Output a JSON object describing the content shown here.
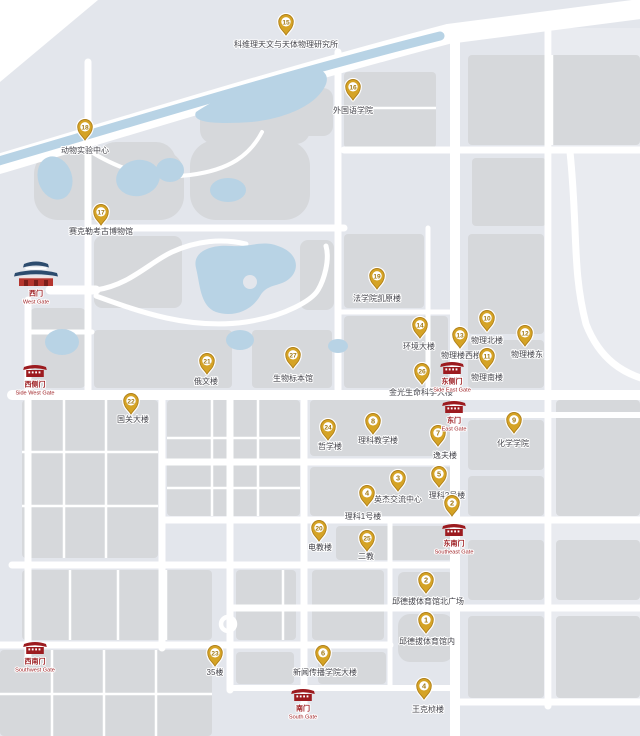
{
  "map": {
    "colors": {
      "background": "#e3e6ec",
      "background_east": "#e9ebf0",
      "building": "#d6d8db",
      "road": "#ffffff",
      "water": "#b8d3e5",
      "marker": "#d5a325",
      "marker_edge": "#b0801a",
      "marker_number": "#a27a15",
      "label": "#45454c",
      "gate_red": "#9c1b1f",
      "gate_base": "#b5352e",
      "gate_blue": "#2d4c6e"
    },
    "markers": [
      {
        "num": "15",
        "x": 286,
        "y": 35,
        "label": "科维理天文与天体物理研究所",
        "lx": 286,
        "ly": 47
      },
      {
        "num": "16",
        "x": 353,
        "y": 100,
        "label": "外国语学院",
        "lx": 353,
        "ly": 113
      },
      {
        "num": "18",
        "x": 85,
        "y": 140,
        "label": "动物实验中心",
        "lx": 85,
        "ly": 153
      },
      {
        "num": "17",
        "x": 101,
        "y": 225,
        "label": "赛克勒考古博物馆",
        "lx": 101,
        "ly": 234
      },
      {
        "num": "19",
        "x": 377,
        "y": 289,
        "label": "法学院凯原楼",
        "lx": 377,
        "ly": 301
      },
      {
        "num": "10",
        "x": 487,
        "y": 331,
        "label": "物理北楼",
        "lx": 487,
        "ly": 343
      },
      {
        "num": "14",
        "x": 420,
        "y": 338,
        "label": "环境大楼",
        "lx": 419,
        "ly": 349
      },
      {
        "num": "12",
        "x": 525,
        "y": 346,
        "label": "物理楼东",
        "lx": 527,
        "ly": 357
      },
      {
        "num": "13",
        "x": 460,
        "y": 348,
        "label": "物理楼西楼",
        "lx": 461,
        "ly": 358
      },
      {
        "num": "11",
        "x": 487,
        "y": 369,
        "label": "物理南楼",
        "lx": 487,
        "ly": 380
      },
      {
        "num": "27",
        "x": 293,
        "y": 368,
        "label": "生物标本馆",
        "lx": 293,
        "ly": 381
      },
      {
        "num": "21",
        "x": 207,
        "y": 374,
        "label": "俄文楼",
        "lx": 206,
        "ly": 384
      },
      {
        "num": "26",
        "x": 422,
        "y": 384,
        "label": "金光生命科学大楼",
        "lx": 421,
        "ly": 395
      },
      {
        "num": "22",
        "x": 131,
        "y": 414,
        "label": "国关大楼",
        "lx": 133,
        "ly": 422
      },
      {
        "num": "8",
        "x": 373,
        "y": 434,
        "label": "理科教学楼",
        "lx": 378,
        "ly": 443
      },
      {
        "num": "9",
        "x": 514,
        "y": 433,
        "label": "化学学院",
        "lx": 513,
        "ly": 446
      },
      {
        "num": "24",
        "x": 328,
        "y": 440,
        "label": "哲学楼",
        "lx": 330,
        "ly": 449
      },
      {
        "num": "7",
        "x": 438,
        "y": 446,
        "label": "逸夫楼",
        "lx": 445,
        "ly": 458
      },
      {
        "num": "5",
        "x": 439,
        "y": 487,
        "label": "理科2号楼",
        "lx": 447,
        "ly": 498
      },
      {
        "num": "3",
        "x": 398,
        "y": 491,
        "label": "英杰交流中心",
        "lx": 398,
        "ly": 502
      },
      {
        "num": "4",
        "x": 367,
        "y": 506,
        "label": "理科1号楼",
        "lx": 363,
        "ly": 519
      },
      {
        "num": "2",
        "x": 452,
        "y": 516,
        "label": "",
        "lx": 452,
        "ly": 516
      },
      {
        "num": "20",
        "x": 319,
        "y": 541,
        "label": "电教楼",
        "lx": 320,
        "ly": 550
      },
      {
        "num": "25",
        "x": 367,
        "y": 551,
        "label": "二教",
        "lx": 366,
        "ly": 559
      },
      {
        "num": "2",
        "x": 426,
        "y": 593,
        "label": "邱德拔体育馆北广场",
        "lx": 428,
        "ly": 604
      },
      {
        "num": "1",
        "x": 426,
        "y": 633,
        "label": "邱德拔体育馆内",
        "lx": 427,
        "ly": 644
      },
      {
        "num": "23",
        "x": 215,
        "y": 666,
        "label": "35楼",
        "lx": 215,
        "ly": 675
      },
      {
        "num": "6",
        "x": 323,
        "y": 666,
        "label": "新闻传播学院大楼",
        "lx": 325,
        "ly": 675
      },
      {
        "num": "4",
        "x": 424,
        "y": 699,
        "label": "王克桢楼",
        "lx": 428,
        "ly": 712
      }
    ],
    "gates": [
      {
        "id": "west-gate",
        "zh": "西门",
        "en": "West Gate",
        "x": 36,
        "y": 286,
        "style": "landmark"
      },
      {
        "id": "side-west-gate",
        "zh": "西侧门",
        "en": "Side West Gate",
        "x": 35,
        "y": 377,
        "style": "red"
      },
      {
        "id": "southwest-gate",
        "zh": "西南门",
        "en": "Southwest Gate",
        "x": 35,
        "y": 654,
        "style": "red"
      },
      {
        "id": "south-gate",
        "zh": "南门",
        "en": "South Gate",
        "x": 303,
        "y": 701,
        "style": "red"
      },
      {
        "id": "southeast-gate",
        "zh": "东南门",
        "en": "Southeast Gate",
        "x": 454,
        "y": 536,
        "style": "red"
      },
      {
        "id": "east-gate",
        "zh": "东门",
        "en": "East Gate",
        "x": 454,
        "y": 413,
        "style": "red"
      },
      {
        "id": "side-east-gate",
        "zh": "东侧门",
        "en": "Side East Gate",
        "x": 452,
        "y": 374,
        "style": "red"
      }
    ]
  }
}
